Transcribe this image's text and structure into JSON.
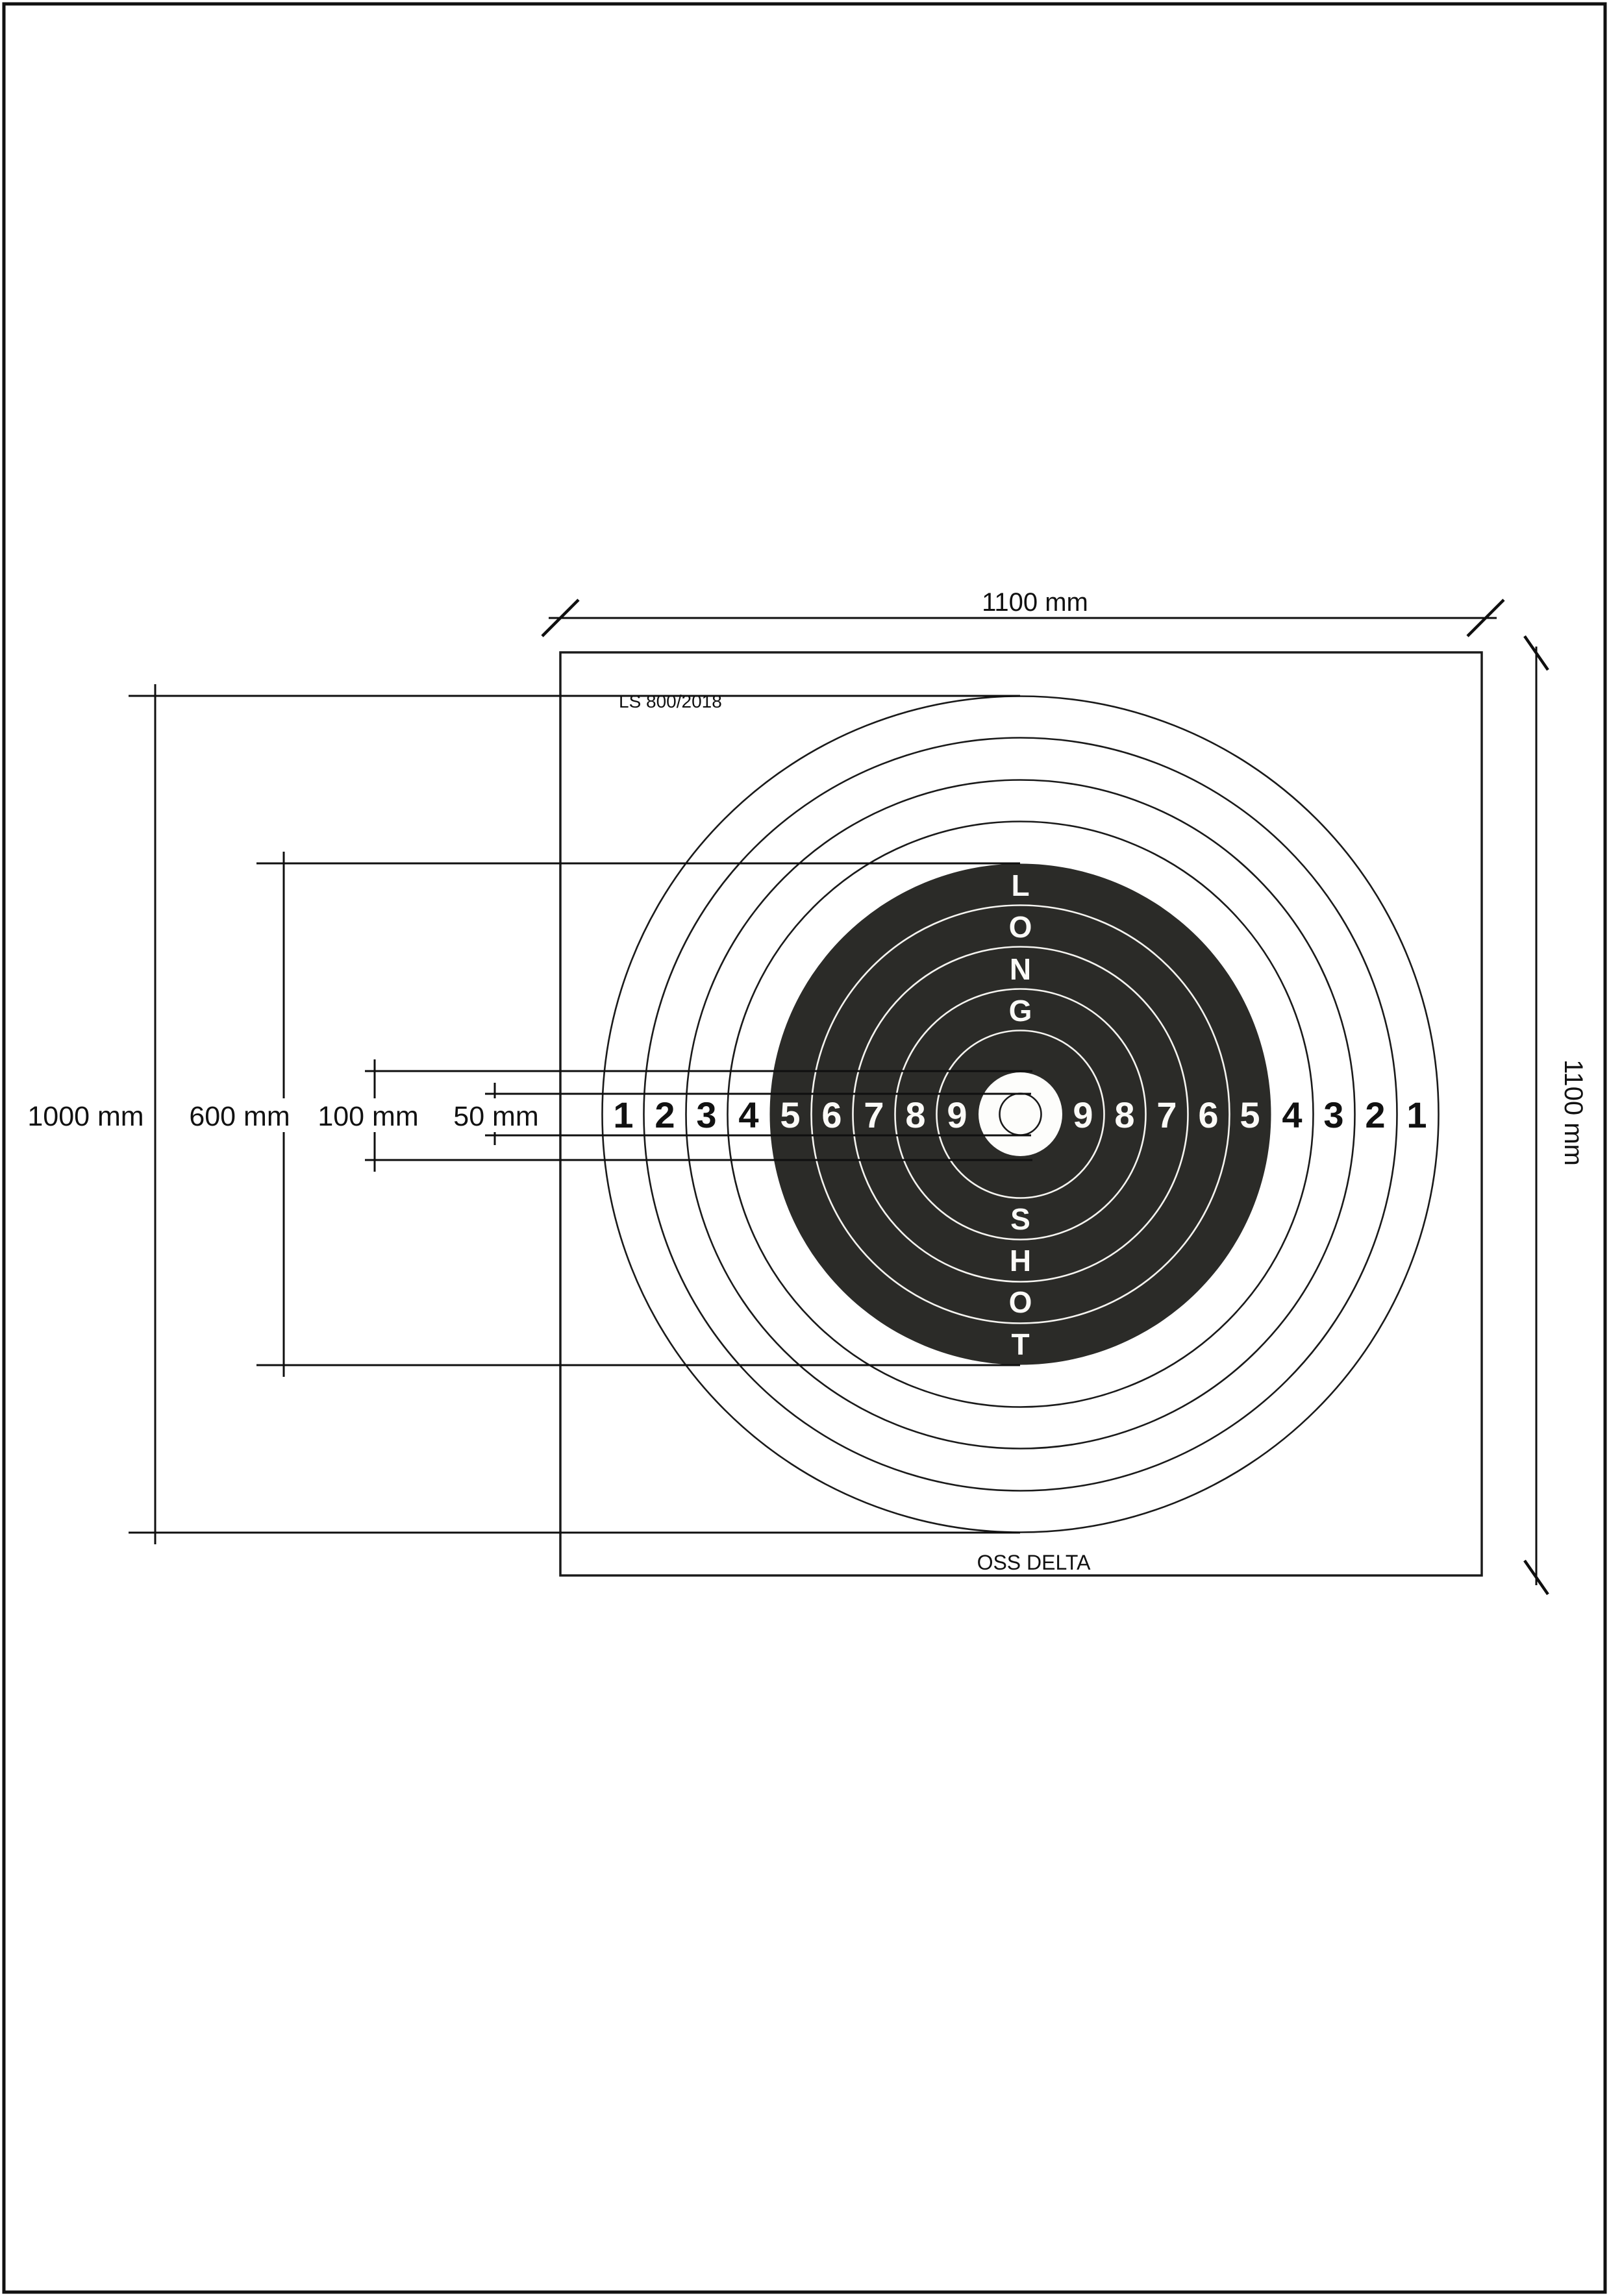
{
  "colors": {
    "ink": "#0f0f0f",
    "black_zone": "#2b2b28",
    "paper": "#ffffff",
    "ring_text_white": "#fbfaf7"
  },
  "target": {
    "model_label": "LS 800/2018",
    "brand_label": "OSS DELTA",
    "word_top": [
      "L",
      "O",
      "N",
      "G"
    ],
    "word_bottom": [
      "S",
      "H",
      "O",
      "T"
    ],
    "ring_numbers_left": [
      "1",
      "2",
      "3",
      "4",
      "5",
      "6",
      "7",
      "8",
      "9"
    ],
    "ring_numbers_right": [
      "9",
      "8",
      "7",
      "6",
      "5",
      "4",
      "3",
      "2",
      "1"
    ]
  },
  "dimensions": {
    "top": "1100 mm",
    "right": "1100 mm",
    "left": [
      {
        "label": "1000 mm"
      },
      {
        "label": "600 mm"
      },
      {
        "label": "100 mm"
      },
      {
        "label": "50 mm"
      }
    ]
  }
}
